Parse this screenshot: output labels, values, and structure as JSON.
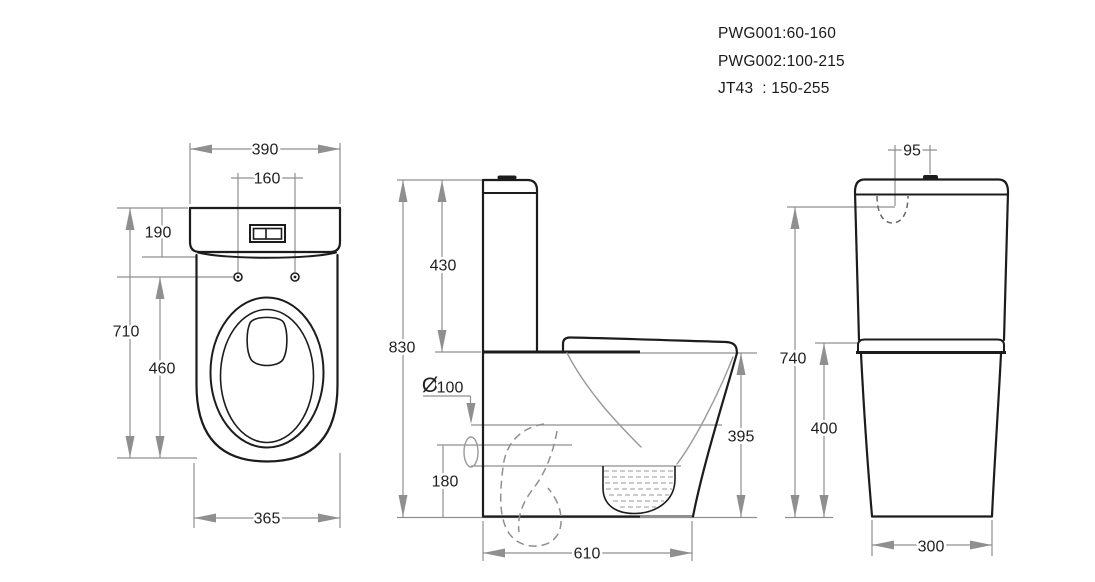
{
  "header": {
    "models": [
      "PWG001:60-160",
      "PWG002:100-215",
      "JT43  : 150-255"
    ]
  },
  "views": {
    "front": {
      "title": "front-view",
      "width_top": "390",
      "hole_spacing": "160",
      "tank_height": "190",
      "overall_height": "710",
      "rim_height": "460",
      "width_base": "365"
    },
    "side": {
      "title": "side-view",
      "tank_height": "430",
      "overall_height": "830",
      "outlet_symbol": "Ø",
      "outlet_size": "100",
      "outlet_center_height": "180",
      "rim_height": "395",
      "depth": "610"
    },
    "back": {
      "title": "back-view",
      "inlet_offset": "95",
      "inlet_height": "740",
      "shelf_height": "400",
      "width_base": "300"
    }
  },
  "colors": {
    "background": "#ffffff",
    "outline": "#1c1c1c",
    "dimension_lines": "#8f8f8f",
    "dimension_text": "#1f1f1f"
  }
}
